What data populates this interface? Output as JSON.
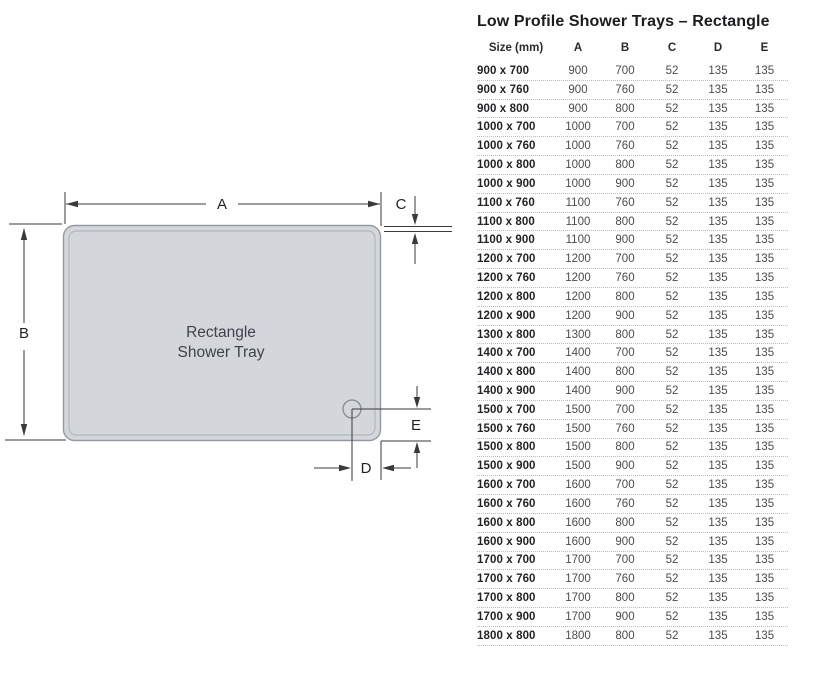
{
  "title": "Low Profile Shower Trays – Rectangle",
  "diagram": {
    "tray_label_line1": "Rectangle",
    "tray_label_line2": "Shower Tray",
    "labels": {
      "a": "A",
      "b": "B",
      "c": "C",
      "d": "D",
      "e": "E"
    },
    "colors": {
      "tray_fill": "#d3d7dc",
      "tray_border": "#939aa1",
      "inner_line": "#b2b7bd",
      "drain_stroke": "#858b92",
      "dimension_line": "#3a3a3a",
      "label_text": "#222326",
      "tray_text": "#3e434a"
    }
  },
  "table": {
    "headers": [
      "Size (mm)",
      "A",
      "B",
      "C",
      "D",
      "E"
    ],
    "rows": [
      [
        "900 x 700",
        "900",
        "700",
        "52",
        "135",
        "135"
      ],
      [
        "900 x 760",
        "900",
        "760",
        "52",
        "135",
        "135"
      ],
      [
        "900 x 800",
        "900",
        "800",
        "52",
        "135",
        "135"
      ],
      [
        "1000 x 700",
        "1000",
        "700",
        "52",
        "135",
        "135"
      ],
      [
        "1000 x 760",
        "1000",
        "760",
        "52",
        "135",
        "135"
      ],
      [
        "1000 x 800",
        "1000",
        "800",
        "52",
        "135",
        "135"
      ],
      [
        "1000 x 900",
        "1000",
        "900",
        "52",
        "135",
        "135"
      ],
      [
        "1100 x 760",
        "1100",
        "760",
        "52",
        "135",
        "135"
      ],
      [
        "1100 x 800",
        "1100",
        "800",
        "52",
        "135",
        "135"
      ],
      [
        "1100 x 900",
        "1100",
        "900",
        "52",
        "135",
        "135"
      ],
      [
        "1200 x 700",
        "1200",
        "700",
        "52",
        "135",
        "135"
      ],
      [
        "1200 x 760",
        "1200",
        "760",
        "52",
        "135",
        "135"
      ],
      [
        "1200 x 800",
        "1200",
        "800",
        "52",
        "135",
        "135"
      ],
      [
        "1200 x 900",
        "1200",
        "900",
        "52",
        "135",
        "135"
      ],
      [
        "1300 x 800",
        "1300",
        "800",
        "52",
        "135",
        "135"
      ],
      [
        "1400 x 700",
        "1400",
        "700",
        "52",
        "135",
        "135"
      ],
      [
        "1400 x 800",
        "1400",
        "800",
        "52",
        "135",
        "135"
      ],
      [
        "1400 x 900",
        "1400",
        "900",
        "52",
        "135",
        "135"
      ],
      [
        "1500 x 700",
        "1500",
        "700",
        "52",
        "135",
        "135"
      ],
      [
        "1500 x 760",
        "1500",
        "760",
        "52",
        "135",
        "135"
      ],
      [
        "1500 x 800",
        "1500",
        "800",
        "52",
        "135",
        "135"
      ],
      [
        "1500 x 900",
        "1500",
        "900",
        "52",
        "135",
        "135"
      ],
      [
        "1600 x 700",
        "1600",
        "700",
        "52",
        "135",
        "135"
      ],
      [
        "1600 x 760",
        "1600",
        "760",
        "52",
        "135",
        "135"
      ],
      [
        "1600 x 800",
        "1600",
        "800",
        "52",
        "135",
        "135"
      ],
      [
        "1600 x 900",
        "1600",
        "900",
        "52",
        "135",
        "135"
      ],
      [
        "1700 x 700",
        "1700",
        "700",
        "52",
        "135",
        "135"
      ],
      [
        "1700 x 760",
        "1700",
        "760",
        "52",
        "135",
        "135"
      ],
      [
        "1700 x 800",
        "1700",
        "800",
        "52",
        "135",
        "135"
      ],
      [
        "1700 x 900",
        "1700",
        "900",
        "52",
        "135",
        "135"
      ],
      [
        "1800 x 800",
        "1800",
        "800",
        "52",
        "135",
        "135"
      ]
    ]
  }
}
